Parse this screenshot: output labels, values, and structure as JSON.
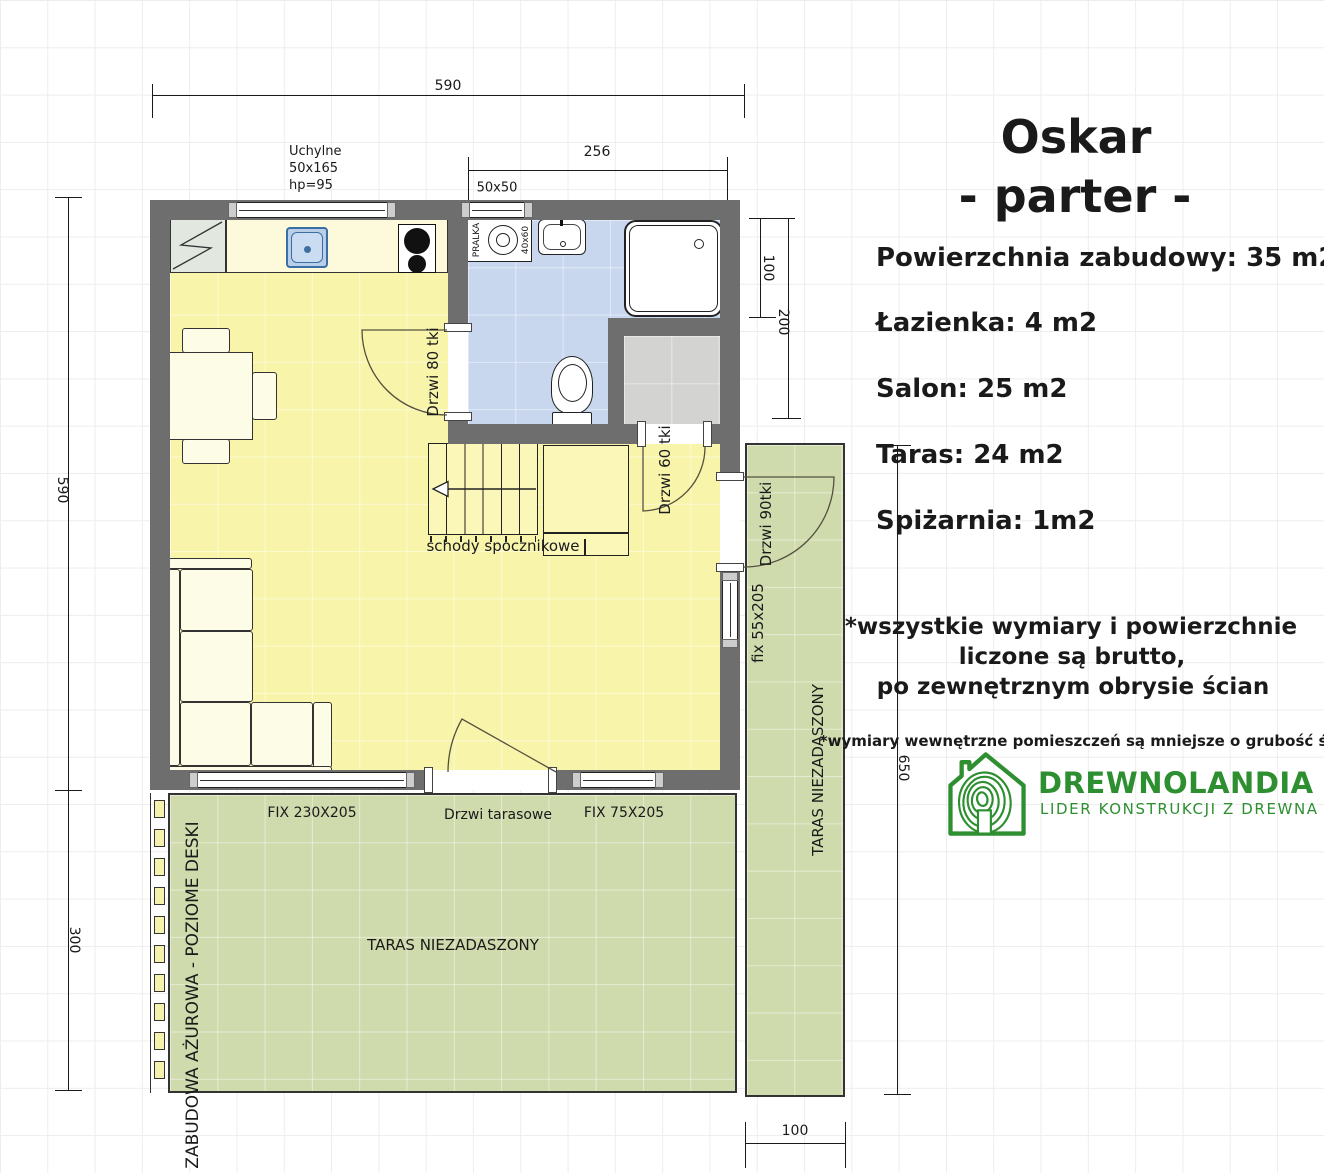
{
  "plan": {
    "dims": {
      "house_width_top": "590",
      "house_height_left": "590",
      "terrace_height_left": "300",
      "bath_width": "256",
      "bath_window_size": "50x50",
      "shower_depth": "100",
      "bath_depth": "200",
      "side_terrace_length": "650",
      "side_terrace_width": "100"
    },
    "windows": {
      "tilt_line1": "Uchylne",
      "tilt_line2": "50x165",
      "tilt_line3": "hp=95",
      "fix_large": "FIX 230X205",
      "fix_small": "FIX 75X205",
      "fix_side": "fix 55x205"
    },
    "doors": {
      "bath": "Drzwi 80 tki",
      "pantry": "Drzwi 60 tki",
      "side": "Drzwi 90tki",
      "terrace": "Drzwi tarasowe"
    },
    "labels": {
      "stairs": "schody spocznikowe",
      "washer": "PRALKA",
      "washer_size": "40x60",
      "terrace_main": "TARAS NIEZADASZONY",
      "terrace_side": "TARAS NIEZADASZONY",
      "cladding": "ZABUDOWA AŻUROWA - POZIOME DESKI"
    }
  },
  "info_panel": {
    "title": "Oskar",
    "subtitle": "- parter -",
    "areas": [
      "Powierzchnia zabudowy: 35 m2",
      "Łazienka: 4 m2",
      "Salon: 25 m2",
      "Taras: 24 m2",
      "Spiżarnia: 1m2"
    ],
    "note_primary": [
      "*wszystkie wymiary i powierzchnie",
      "liczone są brutto,",
      "po zewnętrznym obrysie ścian"
    ],
    "note_secondary": "*wymiary wewnętrzne pomieszczeń są mniejsze o grubość ścian",
    "logo": {
      "name": "DREWNOLANDIA",
      "tagline": "LIDER KONSTRUKCJI Z DREWNA"
    }
  },
  "colors": {
    "wall": "#6e6e6e",
    "salon_floor": "#f8f5ab",
    "bathroom_floor": "#c8d7ee",
    "pantry_floor": "#d3d3d1",
    "terrace": "#cfdaad",
    "counter": "#fcfadb",
    "stairs": "#faf7b8",
    "boards": "#f5f2ae",
    "logo_green": "#2e8f31"
  }
}
